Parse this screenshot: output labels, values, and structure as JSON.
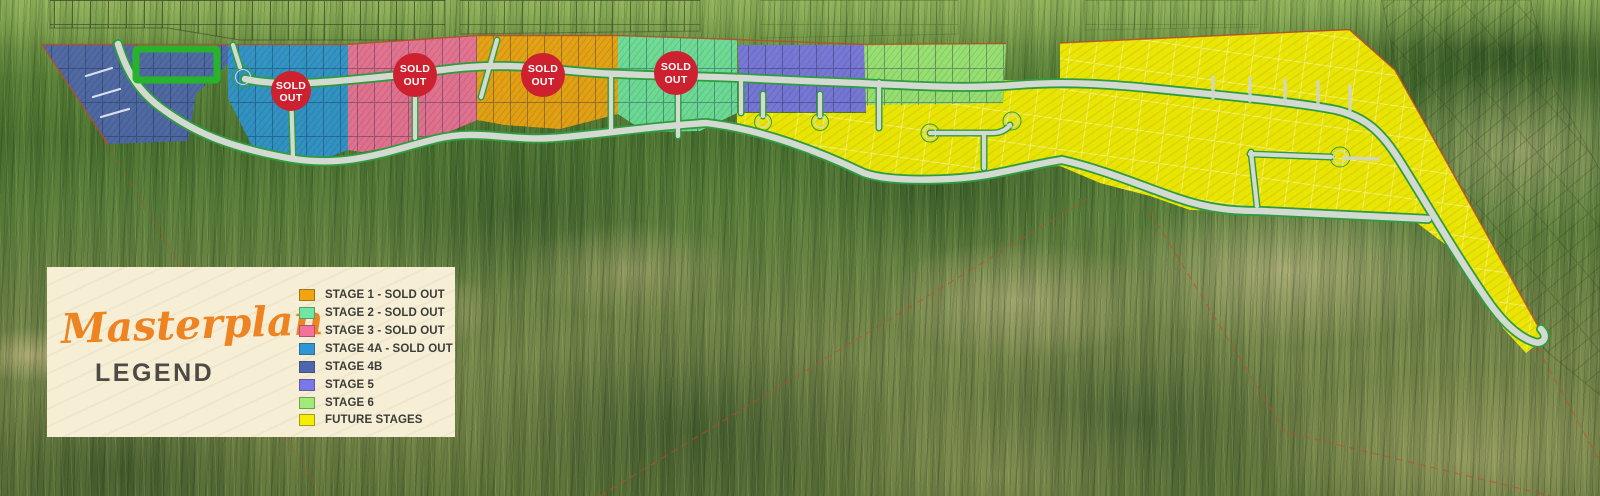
{
  "panel": {
    "script_title": "Masterplan",
    "subtitle": "LEGEND",
    "bg": "#f6efd6",
    "script_color": "#ee8322",
    "subtitle_color": "#4c4a44"
  },
  "badge": {
    "line1": "SOLD",
    "line2": "OUT",
    "fill": "#ce2130",
    "text_color": "#ffffff"
  },
  "legend": {
    "items": [
      {
        "id": "stage-1",
        "label": "STAGE 1 - SOLD OUT",
        "color": "#f2a411"
      },
      {
        "id": "stage-2",
        "label": "STAGE 2 - SOLD OUT",
        "color": "#6fe6a1"
      },
      {
        "id": "stage-3",
        "label": "STAGE 3 - SOLD OUT",
        "color": "#f4719b"
      },
      {
        "id": "stage-4a",
        "label": "STAGE 4A - SOLD OUT",
        "color": "#2d96d6"
      },
      {
        "id": "stage-4b",
        "label": "STAGE 4B",
        "color": "#4e66b0"
      },
      {
        "id": "stage-5",
        "label": "STAGE 5",
        "color": "#7b76e9"
      },
      {
        "id": "stage-6",
        "label": "STAGE 6",
        "color": "#9fec79"
      },
      {
        "id": "future",
        "label": "FUTURE STAGES",
        "color": "#f5ee00"
      }
    ]
  },
  "map": {
    "road_fill": "#d4dad1",
    "road_edge": "#2f9d3f",
    "boundary": "#b84c28",
    "cadastral": "#cf4526",
    "park_outline": "#27b42b"
  }
}
